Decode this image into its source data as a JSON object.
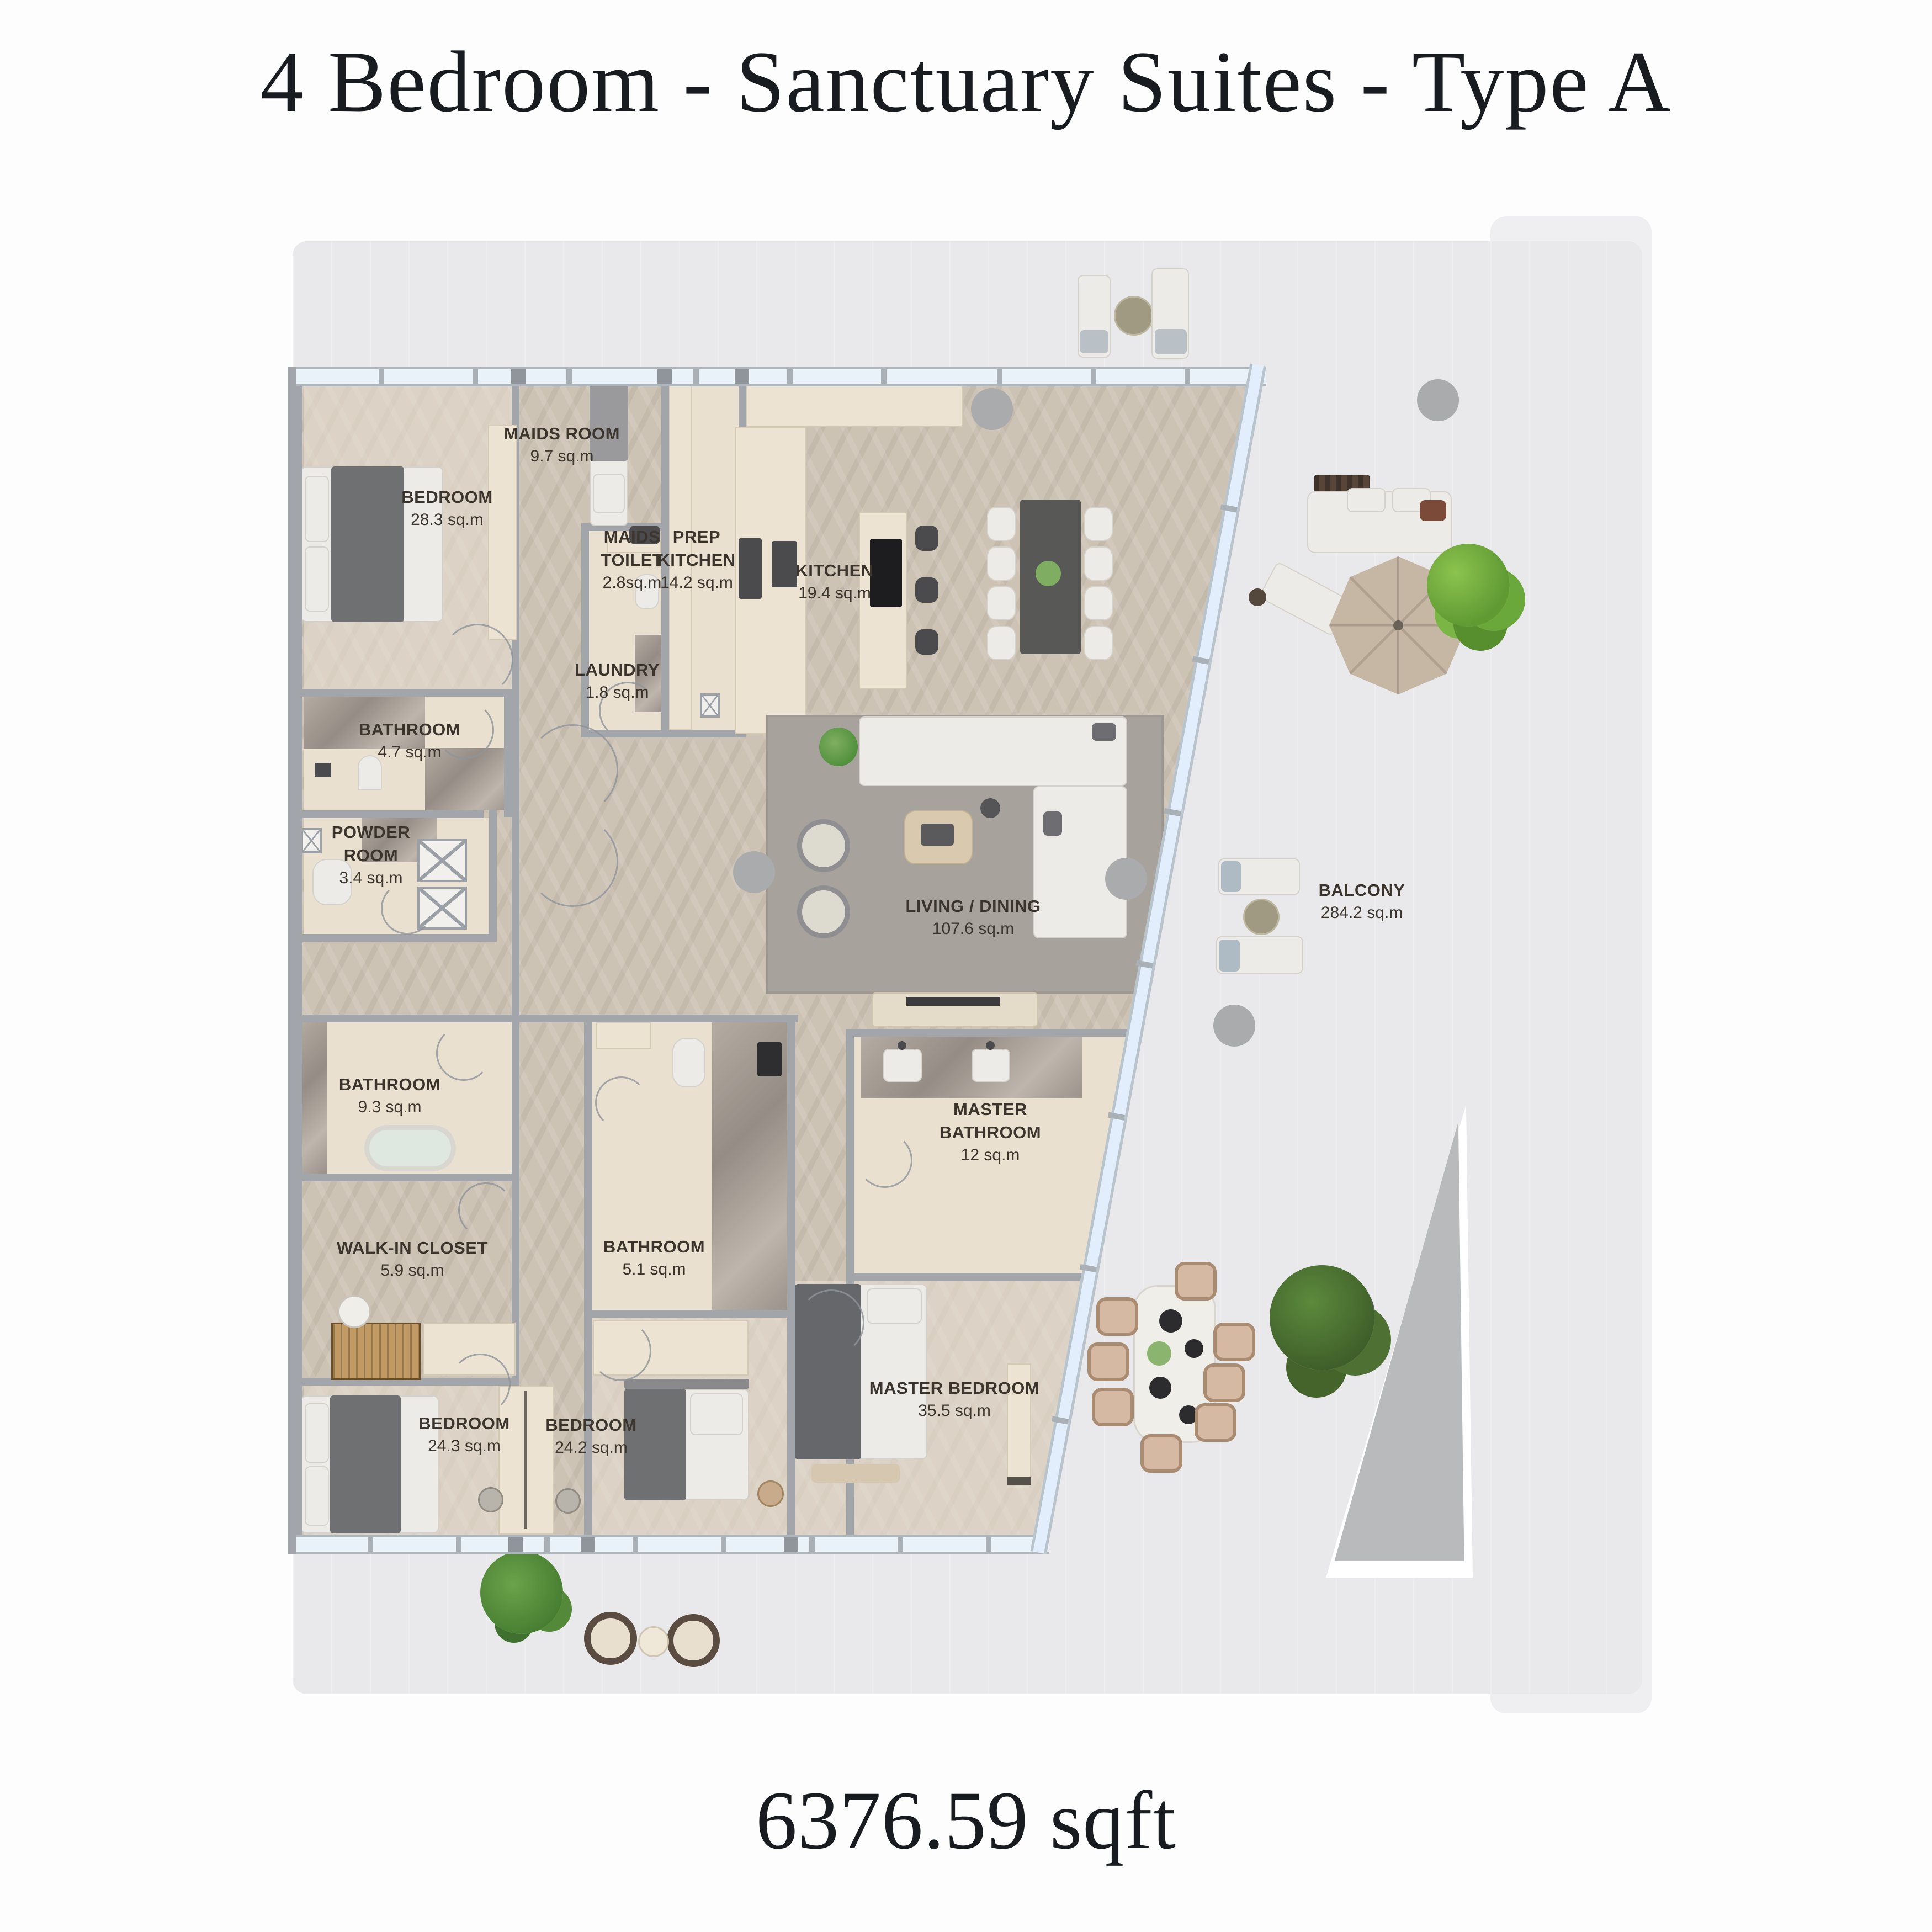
{
  "title": "4 Bedroom - Sanctuary Suites - Type A",
  "total_area": "6376.59 sqft",
  "rooms": [
    {
      "id": "bedroom-1",
      "name": "BEDROOM",
      "area": "28.3 sq.m"
    },
    {
      "id": "maids-room",
      "name": "MAIDS ROOM",
      "area": "9.7 sq.m"
    },
    {
      "id": "maids-toilet",
      "name": "MAIDS\nTOILET",
      "area": "2.8sq.m"
    },
    {
      "id": "prep-kitchen",
      "name": "PREP\nKITCHEN",
      "area": "14.2 sq.m"
    },
    {
      "id": "kitchen",
      "name": "KITCHEN",
      "area": "19.4 sq.m"
    },
    {
      "id": "laundry",
      "name": "LAUNDRY",
      "area": "1.8 sq.m"
    },
    {
      "id": "bathroom-4-7",
      "name": "BATHROOM",
      "area": "4.7 sq.m"
    },
    {
      "id": "powder-room",
      "name": "POWDER\nROOM",
      "area": "3.4 sq.m"
    },
    {
      "id": "living-dining",
      "name": "LIVING / DINING",
      "area": "107.6 sq.m"
    },
    {
      "id": "bathroom-9-3",
      "name": "BATHROOM",
      "area": "9.3 sq.m"
    },
    {
      "id": "master-bathroom",
      "name": "MASTER\nBATHROOM",
      "area": "12 sq.m"
    },
    {
      "id": "walk-in-closet",
      "name": "WALK-IN CLOSET",
      "area": "5.9 sq.m"
    },
    {
      "id": "bathroom-5-1",
      "name": "BATHROOM",
      "area": "5.1 sq.m"
    },
    {
      "id": "bedroom-24-3",
      "name": "BEDROOM",
      "area": "24.3 sq.m"
    },
    {
      "id": "bedroom-24-2",
      "name": "BEDROOM",
      "area": "24.2 sq.m"
    },
    {
      "id": "master-bedroom",
      "name": "MASTER BEDROOM",
      "area": "35.5 sq.m"
    },
    {
      "id": "balcony",
      "name": "BALCONY",
      "area": "284.2 sq.m"
    }
  ],
  "colors": {
    "title_ink": "#181b20",
    "label_ink": "#3b352d",
    "wood_floor": "#cdc3b5",
    "terrace_floor": "#e9e9eb",
    "glass": "#e9f2f9",
    "wall": "#a2a6ab",
    "cabinetry": "#ece3d2",
    "marble": "#a39b92",
    "rug": "#a7a39c",
    "greenery": "#6aa83b",
    "umbrella": "#c6b7a4"
  }
}
